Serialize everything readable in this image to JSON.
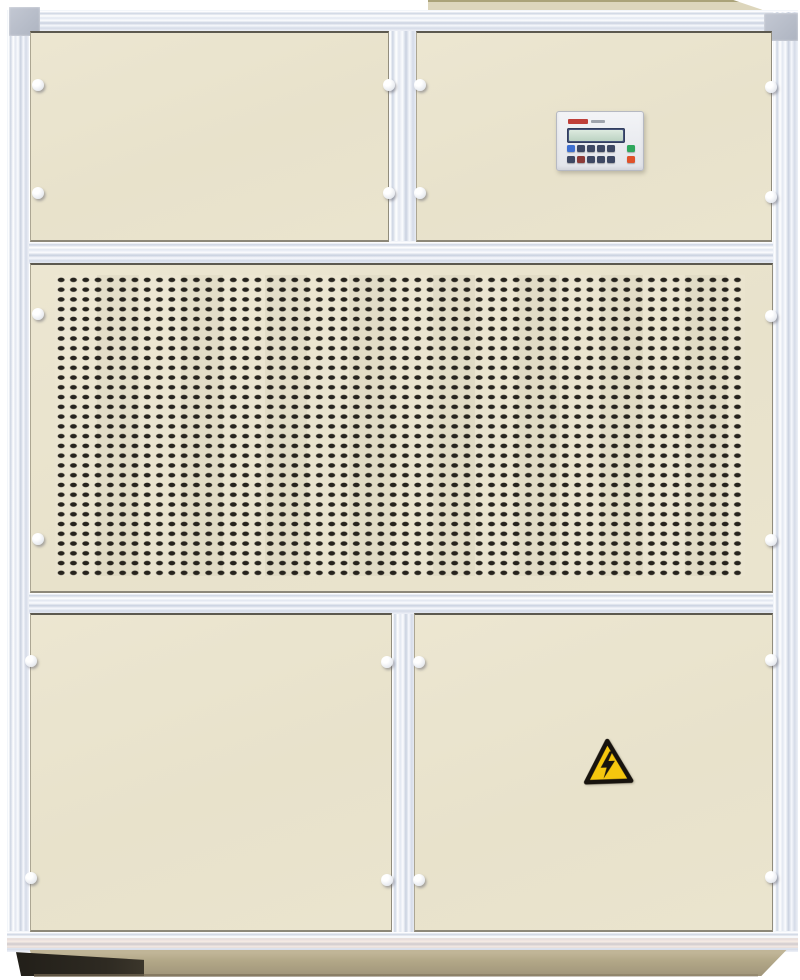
{
  "meta": {
    "type": "photograph",
    "subject": "Industrial packaged air-handling / dehumidifier cabinet",
    "description": "Front view of a floor-standing HVAC cabinet with cream enamel panels in a silver aluminium frame: two blank access panels on top (the right one carries a small digital controller with LCD and keypad), a full-width perforated air-intake grille across the middle, two blank access doors below with a yellow high-voltage warning triangle on the lower-right door, all standing on a tan plinth base with a duct collar on top."
  },
  "palette": {
    "background": "#ffffff",
    "panel_cream": "#e9e3cd",
    "frame_aluminium": "#e4e9f2",
    "panel_gap_line": "#3e3b34",
    "grille_slot": "#26231d",
    "base_tan": "#b3a888",
    "shadow_dark": "#26221b",
    "collar_beige": "#ddd6bc"
  },
  "cabinet": {
    "top_collar": {
      "name": "top duct collar",
      "color": "#ddd6bc"
    },
    "frame": {
      "rails": [
        "top",
        "left",
        "right",
        "bottom"
      ],
      "corner_caps": 2,
      "mullions": 2,
      "mid_rails": 2
    },
    "panels": [
      {
        "id": "upper-left",
        "kind": "blank access panel",
        "fasteners": 4
      },
      {
        "id": "upper-right",
        "kind": "access panel with controller",
        "fasteners": 4
      },
      {
        "id": "middle",
        "kind": "perforated intake grille",
        "fasteners": 4
      },
      {
        "id": "lower-left",
        "kind": "blank access door",
        "fasteners": 4
      },
      {
        "id": "lower-right",
        "kind": "access door with warning label",
        "fasteners": 4
      }
    ],
    "fastener_knob_total": 20,
    "base": {
      "name": "plinth",
      "color": "#b3a888"
    }
  },
  "controller": {
    "brand_mark": "small red logo, illegible at this scale",
    "display": {
      "kind": "monochrome LCD",
      "bezel_color": "#46537a",
      "screen_color": "#cfe0d2",
      "text": ""
    },
    "buttons": {
      "row1": [
        "blue",
        "navy",
        "navy",
        "navy",
        "navy",
        "green"
      ],
      "row2": [
        "navy",
        "dark-red",
        "navy",
        "navy",
        "navy",
        "red"
      ]
    },
    "button_colors": {
      "blue": "#3e6fd0",
      "navy": "#3d4763",
      "green": "#2fa75c",
      "red": "#e0512a",
      "dark-red": "#8c3a38"
    }
  },
  "warning_label": {
    "symbol": "lightning bolt in triangle",
    "meaning": "high voltage",
    "background": "#f5c70e",
    "foreground": "#17130e"
  },
  "grille": {
    "pattern": "dense grid of small rounded rectangular slots",
    "approx_columns": 56,
    "approx_rows": 31,
    "slot_color": "#26231d"
  }
}
